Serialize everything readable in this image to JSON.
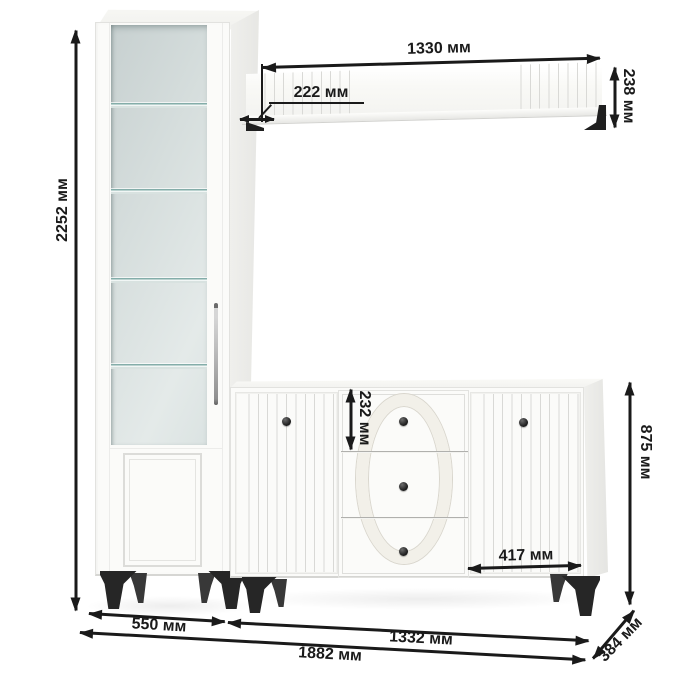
{
  "diagram": {
    "unit": "мм",
    "accent_color": "#1a1a1a",
    "furniture_color": "#fbfbf9",
    "glass_color": "#d6dedd",
    "hardware_color": "#262626",
    "dimensions": {
      "cabinet_height": "2252 мм",
      "shelf_width": "1330 мм",
      "shelf_depth": "222 мм",
      "shelf_height": "238 мм",
      "top_drawer_height": "232 мм",
      "sideboard_height": "875 мм",
      "right_door_width": "417 мм",
      "cabinet_width": "550 мм",
      "sideboard_width": "1332 мм",
      "total_width": "1882 мм",
      "depth": "384 мм"
    }
  }
}
